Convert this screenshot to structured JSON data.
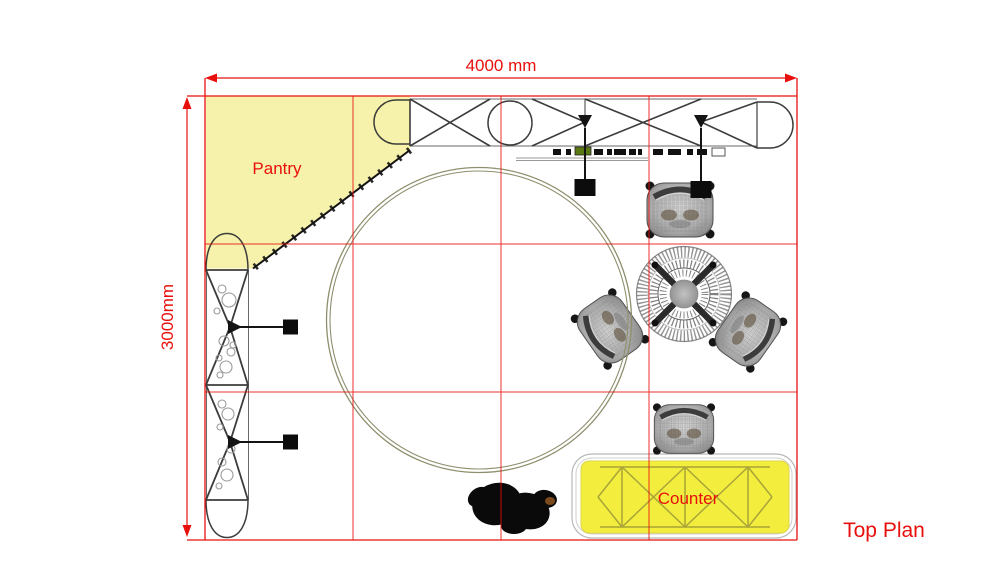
{
  "drawing": {
    "caption": "Top Plan",
    "dimensions": {
      "width": "4000 mm",
      "height": "3000mm"
    },
    "areas": {
      "pantry": "Pantry",
      "counter": "Counter"
    }
  },
  "colors": {
    "annotation_red": "#e8100c",
    "pantry_fill": "#f6f2ab",
    "counter_fill": "#f3ee3e",
    "counter_truss": "#a9a437",
    "truss_line": "#3c3c3a",
    "ring": "#8f8f6e"
  }
}
